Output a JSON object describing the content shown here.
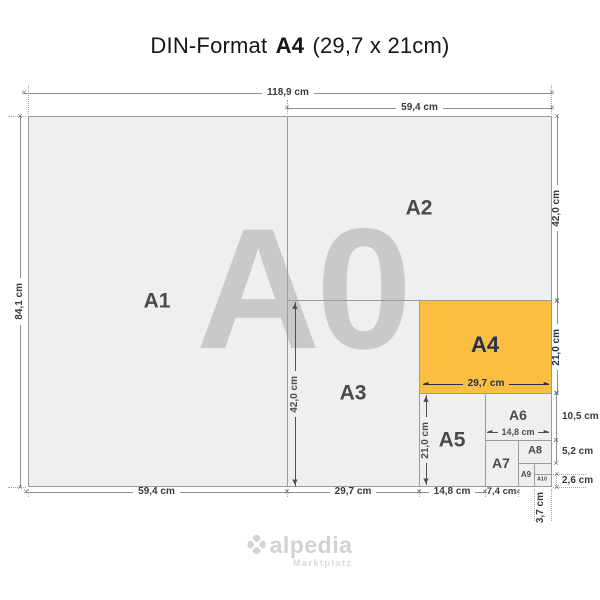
{
  "title": {
    "prefix": "DIN-Format",
    "format": "A4",
    "suffix": "(29,7 x 21cm)"
  },
  "watermark": "A0",
  "format_labels": {
    "a1": "A1",
    "a2": "A2",
    "a3": "A3",
    "a4": "A4",
    "a5": "A5",
    "a6": "A6",
    "a7": "A7",
    "a8": "A8",
    "a9": "A9",
    "a10": "A10"
  },
  "dimensions": {
    "a0_width": "118,9 cm",
    "a0_height": "84,1 cm",
    "a2_width_top": "59,4 cm",
    "a2_height": "42,0 cm",
    "a4_height": "21,0 cm",
    "a6_height": "10,5 cm",
    "a8_height": "5,2 cm",
    "a10_height": "2,6 cm",
    "a1_width_bottom": "59,4 cm",
    "a3_width_bottom": "29,7 cm",
    "a5_width_bottom": "14,8 cm",
    "a7_width_bottom": "7,4 cm",
    "a10_width": "3,7 cm",
    "a3_height_inner": "42,0 cm",
    "a5_height_inner": "21,0 cm",
    "a4_width_inner": "29,7 cm",
    "a6_width_inner": "14,8 cm"
  },
  "logo": {
    "brand": "alpedia",
    "tagline": "Marktplatz"
  },
  "colors": {
    "highlight_fill": "#FBBE41",
    "highlight_text": "#21314E",
    "paper_fill": "#EFEFEF",
    "grid_line": "#9B9B9B",
    "watermark": "#C9C9C9",
    "label_text": "#4A4A4A",
    "dim_text": "#3A3A3A"
  }
}
